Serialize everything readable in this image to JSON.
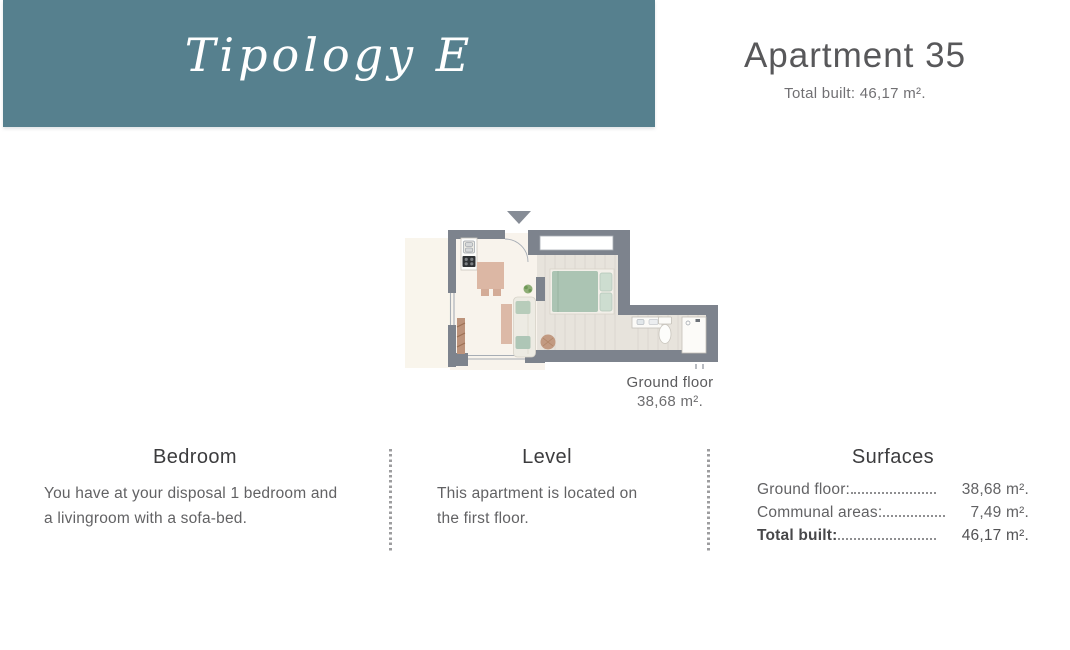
{
  "banner": {
    "title": "Tipology E",
    "bg_color": "#56808e"
  },
  "header": {
    "title": "Apartment 35",
    "subtitle": "Total built: 46,17 m²."
  },
  "floor_plan": {
    "label": "Ground floor",
    "area": "38,68 m².",
    "icons": [
      "entrance-arrow-icon",
      "kitchen-unit-icon",
      "dining-table-icon",
      "sofa-icon",
      "coffee-table-icon",
      "plant-icon",
      "bed-icon",
      "pouf-icon",
      "vanity-icon",
      "toilet-icon",
      "shower-icon"
    ],
    "wall_color": "#7d838d",
    "floor_color": "#f8f3ec",
    "wood_floor_color": "#e7e3dc",
    "accent_sage": "#abc4b3",
    "accent_tan": "#dcb7a4"
  },
  "sections": {
    "bedroom": {
      "heading": "Bedroom",
      "body": "You have at your disposal 1 bedroom and a livingroom with a sofa-bed."
    },
    "level": {
      "heading": "Level",
      "body": "This apartment is located on the first floor."
    },
    "surfaces": {
      "heading": "Surfaces",
      "rows": [
        {
          "label": "Ground floor:",
          "value": "38,68 m²."
        },
        {
          "label": "Communal areas:",
          "value": "7,49 m²."
        },
        {
          "label": "Total built:",
          "value": "46,17 m²."
        }
      ]
    }
  }
}
